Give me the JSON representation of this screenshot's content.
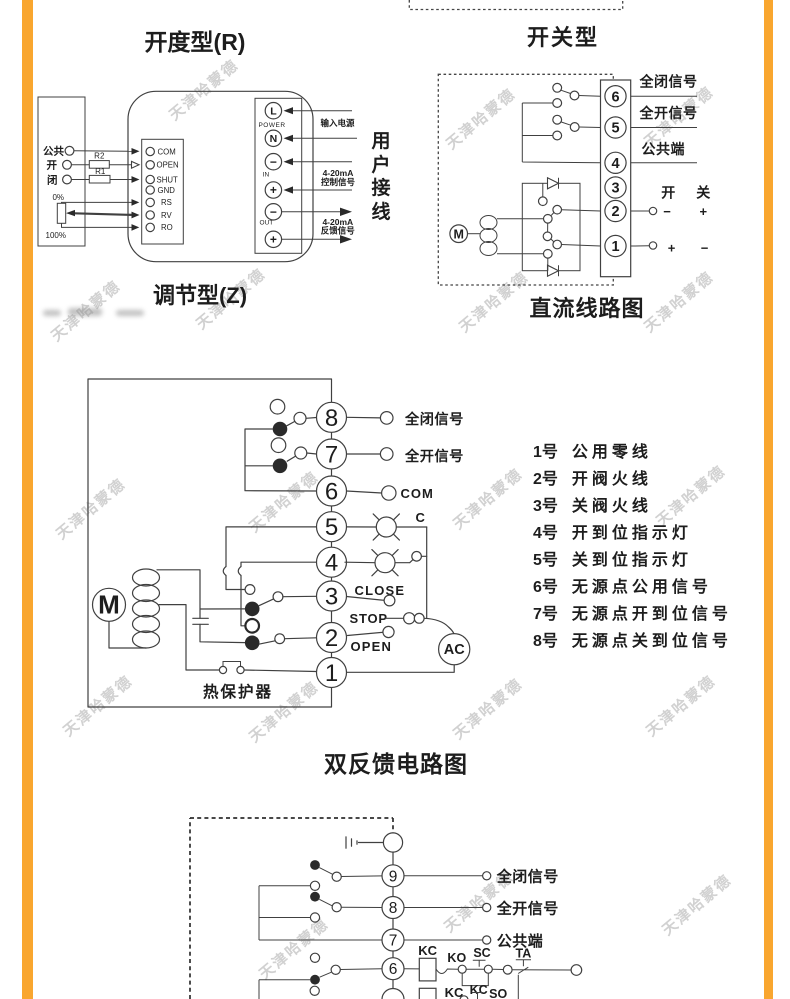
{
  "page": {
    "background": "#ffffff",
    "accent_color": "#F9A62F",
    "watermark": "天津哈蒙德"
  },
  "opening_type": {
    "title": "开度型(R)",
    "subtitle": "调节型(Z)",
    "left_terminals": [
      "公共",
      "开",
      "闭"
    ],
    "resistor_top": "R2",
    "resistor_bottom": "R1",
    "pot_top": "0%",
    "pot_bottom": "100%",
    "board_pins": [
      "COM",
      "OPEN",
      "SHUT",
      "GND",
      "RS",
      "RV",
      "RO"
    ],
    "power_pins": [
      "L",
      "N",
      "−",
      "+",
      "−",
      "+"
    ],
    "group_labels": [
      "POWER",
      "IN",
      "OUT"
    ],
    "arrow_labels": {
      "input_power": "输入电源",
      "control_1": "4-20mA",
      "control_2": "控制信号",
      "feedback_1": "4-20mA",
      "feedback_2": "反馈信号"
    },
    "user_wiring": "用户接线"
  },
  "switch_type": {
    "title": "开关型",
    "subtitle": "直流线路图",
    "terminals": [
      "6",
      "5",
      "4",
      "3",
      "2",
      "1"
    ],
    "signals": {
      "t6": "全闭信号",
      "t5": "全开信号",
      "t4": "公共端"
    },
    "open_label": "开",
    "close_label": "关",
    "row2_polarity": [
      "−",
      "+"
    ],
    "row1_polarity": [
      "+",
      "−"
    ],
    "motor": "M"
  },
  "double_feedback": {
    "title": "双反馈电路图",
    "terminals": [
      "8",
      "7",
      "6",
      "5",
      "4",
      "3",
      "2",
      "1"
    ],
    "signals": {
      "t8": "全闭信号",
      "t7": "全开信号",
      "t6": "COM",
      "lamp": "C",
      "close": "CLOSE",
      "stop": "STOP",
      "open": "OPEN",
      "ac": "AC"
    },
    "motor": "M",
    "thermal": "热保护器",
    "legend": [
      {
        "no": "1号",
        "text": "公用零线"
      },
      {
        "no": "2号",
        "text": "开阀火线"
      },
      {
        "no": "3号",
        "text": "关阀火线"
      },
      {
        "no": "4号",
        "text": "开到位指示灯"
      },
      {
        "no": "5号",
        "text": "关到位指示灯"
      },
      {
        "no": "6号",
        "text": "无源点公用信号"
      },
      {
        "no": "7号",
        "text": "无源点开到位信号"
      },
      {
        "no": "8号",
        "text": "无源点关到位信号"
      }
    ]
  },
  "ac_wiring": {
    "terminals": [
      "9",
      "8",
      "7",
      "6"
    ],
    "signals": {
      "t9": "全闭信号",
      "t8": "全开信号",
      "t7": "公共端"
    },
    "relays": {
      "kc_coil": "KC",
      "ko": "KO",
      "sc": "SC",
      "ta": "TA",
      "kc2": "KC",
      "kc3": "KC",
      "so": "SO"
    }
  }
}
